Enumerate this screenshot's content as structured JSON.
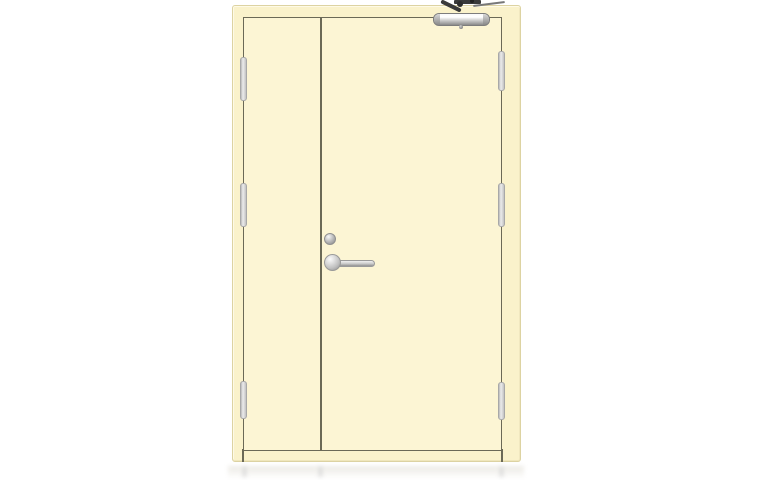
{
  "meta": {
    "description": "Product photograph of a cream-coloured unequal double-leaf steel fire door shown closed on a white background with a faint floor reflection"
  },
  "colors": {
    "background": "#ffffff",
    "frame-cream": "#faf2cb",
    "frame-edge": "#ddd3a2",
    "frame-highlight": "#fefae6",
    "leaf-cream": "#fcf5d4",
    "edge-line": "#6b6956",
    "metal-light": "#f4f4f4",
    "metal-mid": "#c9c9c9",
    "metal-dark": "#8a8a8a",
    "arm-dark": "#3a3a3a",
    "hinge-light": "#ececec",
    "hinge-mid": "#c2c2c2",
    "reflection": "#dcd9cf"
  },
  "door": {
    "type": "double-leaf fire door",
    "finish": "cream painted steel",
    "leaves": [
      {
        "name": "inactive-leaf",
        "position": "left",
        "relative_width": "narrow"
      },
      {
        "name": "active-leaf",
        "position": "right",
        "relative_width": "wide"
      }
    ],
    "hardware": [
      {
        "name": "overhead-door-closer",
        "location": "top of active leaf, hinge side",
        "material": "satin metal with dark arm"
      },
      {
        "name": "cylinder-knob",
        "location": "active leaf, above lever near meeting stile",
        "material": "satin metal"
      },
      {
        "name": "lever-handle",
        "location": "active leaf, meeting stile, pointing right",
        "material": "satin metal"
      },
      {
        "name": "hinge",
        "count": 6,
        "layout": "3 on each outer stile (top, middle, bottom)",
        "material": "satin metal"
      }
    ]
  }
}
